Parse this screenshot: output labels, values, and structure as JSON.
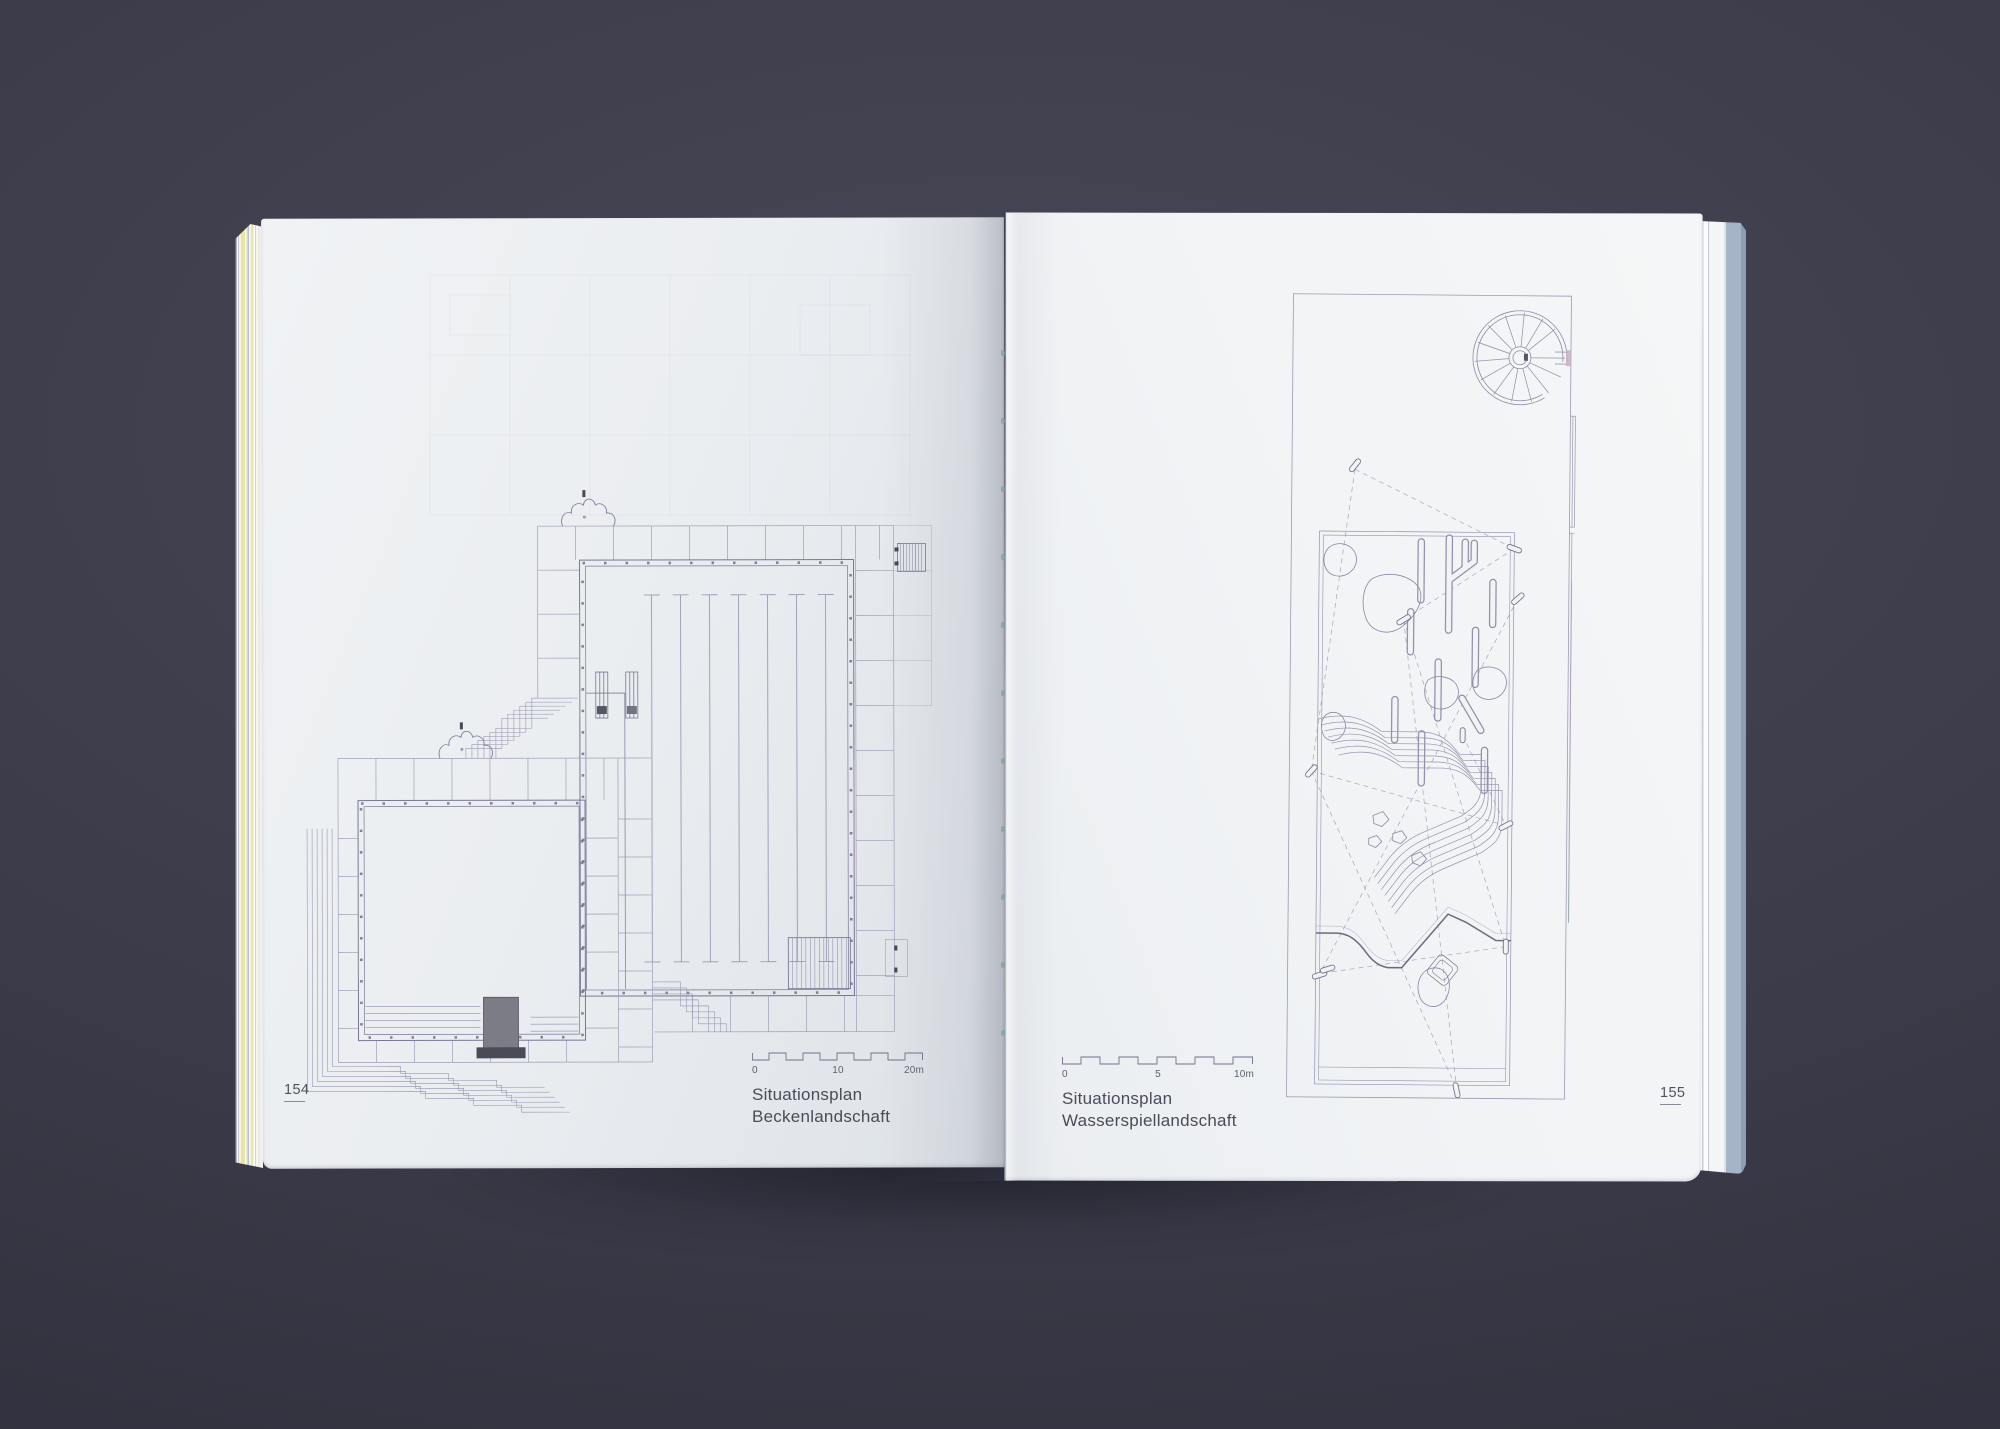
{
  "book": {
    "left_page": {
      "page_number": "154",
      "caption": {
        "line1": "Situationsplan",
        "line2": "Beckenlandschaft"
      },
      "scale_bar": {
        "label_start": "0",
        "label_mid": "10",
        "label_end": "20m"
      }
    },
    "right_page": {
      "page_number": "155",
      "caption": {
        "line1": "Situationsplan",
        "line2": "Wasserspiellandschaft"
      },
      "scale_bar": {
        "label_start": "0",
        "label_mid": "5",
        "label_end": "10m"
      }
    }
  },
  "colors": {
    "backdrop": "#3c3c4a",
    "paper_left": "#ebeef1",
    "paper_right": "#f1f3f5",
    "plan_line": "#8d8daa",
    "plan_line_dark": "#62627e",
    "text": "#4b4b58",
    "fore_edge_yellow": "#e7e4a4",
    "fore_edge_green": "#cddfb2",
    "cover_blue": "#a6b4c7",
    "binding_dot": "#7fa39b",
    "accent_green": "#8fae9a",
    "accent_pink": "#b893ae"
  }
}
